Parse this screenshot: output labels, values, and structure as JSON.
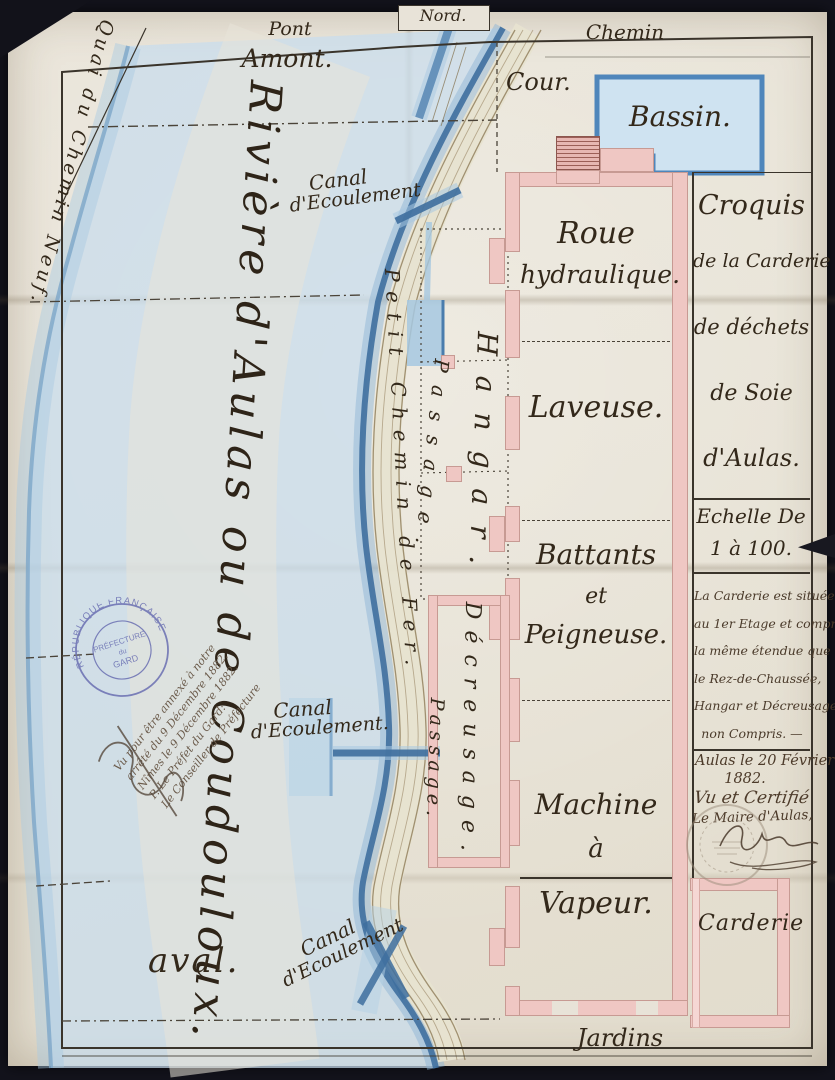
{
  "palette": {
    "background": "#13131c",
    "paper": "#e8e3d8",
    "ink": "#3a342b",
    "wall_pink": "#efc7c3",
    "river_light": "#c8dded",
    "river_dark": "#3f6f9f",
    "basin_fill": "#cfe3f1",
    "basin_edge": "#4f86bb",
    "road_fill": "#e7e3d0",
    "stamp_blue": "#6a6fb2"
  },
  "compass": {
    "north": "Nord."
  },
  "map": {
    "pont": "Pont",
    "amont": "Amont.",
    "chemin": "Chemin",
    "cour": "Cour.",
    "bassin": "Bassin.",
    "quai": "Quai du Chemin Neuf.",
    "river_title": "Rivière d'Aulas ou de Coudouloux.",
    "aval": "aval.",
    "road_label": "Petit Chemin de Fer.",
    "canal_top": [
      "Canal",
      "d'Ecoulement"
    ],
    "canal_mid": [
      "Canal",
      "d'Ecoulement."
    ],
    "canal_bottom": [
      "Canal",
      "d'Ecoulement"
    ],
    "rooms": {
      "roue": [
        "Roue",
        "hydraulique."
      ],
      "laveuse": "Laveuse.",
      "battants": [
        "Battants",
        "et",
        "Peigneuse."
      ],
      "machine": [
        "Machine",
        "à",
        "Vapeur."
      ],
      "hangar": "Hangar.",
      "passage_upper": "Passage.",
      "passage_lower": "Passage.",
      "decreusage": "Décreusage.",
      "carderie": "Carderie",
      "jardins": "Jardins"
    }
  },
  "panel": {
    "title": [
      "Croquis",
      "de la Carderie",
      "de déchets",
      "de Soie",
      "d'Aulas."
    ],
    "scale": [
      "Echelle De",
      "1 à 100."
    ],
    "note": [
      "La Carderie est située",
      "au 1er Etage et comprend",
      "la même étendue que",
      "le Rez-de-Chaussée,",
      "Hangar et Décreusage",
      "non Compris. —"
    ],
    "date": [
      "Aulas le 20 Février",
      "1882."
    ],
    "certified": "Vu et Certifié",
    "maire": "Le Maire d'Aulas,"
  },
  "prefecture": {
    "stamp_ring": "RÉPUBLIQUE FRANÇAISE",
    "stamp_center": [
      "PRÉFECTURE",
      "du",
      "GARD"
    ],
    "note": [
      "Vu pour être annexé à notre",
      "arrêté du 9 Décembre 1882.",
      "Nîmes le 9 Décembre 1882.",
      "P. Le Préfet du Gard:",
      "Le Conseiller de Préfecture"
    ]
  }
}
